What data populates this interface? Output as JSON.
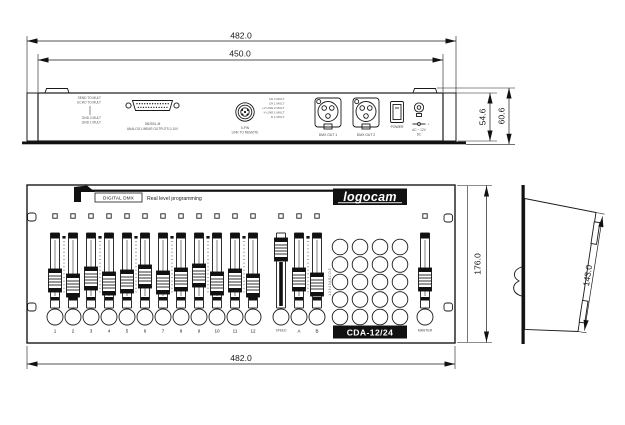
{
  "drawing": {
    "dim_overall_width_top": "482.0",
    "dim_body_width": "450.0",
    "dim_rear_body_height": "54.6",
    "dim_rear_overall_height": "60.6",
    "dim_front_height": "176.0",
    "dim_front_width": "482.0",
    "dim_side_depth": "143.0"
  },
  "rear_panel": {
    "pin_labels_left": [
      "SEND TO MULT",
      "ECHO TO MULT",
      "GND 2 MULT",
      "GND 1 MULT"
    ],
    "db25": {
      "line1": "DB25SL-M",
      "line2": "ANALOG LINEAR OUTPUTS 0-10V"
    },
    "din": {
      "line1": "5-PIN",
      "line2": "LINK TO REMOTE",
      "pins": [
        "CH 2 MULT",
        "CH 1 MULT",
        "+V LINE 2 MULT",
        "-V LINE 1 MULT",
        "D 1 MULT"
      ]
    },
    "xlr1_label": "DMX OUT 1",
    "xlr2_label": "DMX OUT 2",
    "power_label": "POWER",
    "dc": {
      "polarity": "+",
      "line1": "AC ~ 12V",
      "line2": "DC"
    }
  },
  "front_panel": {
    "brand_mark": "LP",
    "digital_dmx_label": "DIGITAL DMX",
    "tagline": "Real level programming",
    "brand_logo": "logocam",
    "model_label": "CDA-12/24",
    "channel_labels": [
      "1",
      "2",
      "3",
      "4",
      "5",
      "6",
      "7",
      "8",
      "9",
      "10",
      "11",
      "12"
    ],
    "speed_label": "SPEED",
    "bank_a_label": "A",
    "bank_b_label": "B",
    "master_label": "MASTER",
    "program_side_label": "1 2 3 4 5 A B C D E"
  }
}
